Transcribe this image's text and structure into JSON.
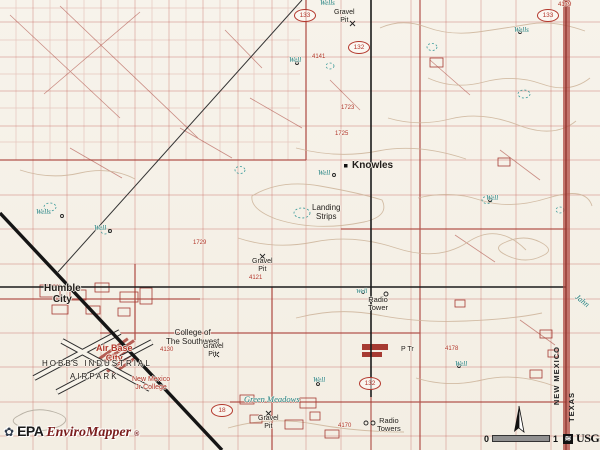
{
  "map": {
    "description": "EPA EnviroMapper USGS topographic map view near Knowles, New Mexico"
  },
  "attribution": {
    "agency": "EPA",
    "product": "EnviroMapper",
    "registered": "®"
  },
  "scale": {
    "zero": "0",
    "one": "1",
    "usgs": "USGS"
  },
  "state_line": {
    "west": "NEW MEXICO",
    "east": "TEXAS"
  },
  "route_shields": [
    {
      "number": "133",
      "x": 294,
      "y": 9
    },
    {
      "number": "132",
      "x": 348,
      "y": 41
    },
    {
      "number": "133",
      "x": 537,
      "y": 9
    },
    {
      "number": "132",
      "x": 359,
      "y": 377
    },
    {
      "number": "18",
      "x": 211,
      "y": 404
    }
  ],
  "map_labels": [
    {
      "name": "label-wells",
      "text": "Wells",
      "x": 320,
      "y": 0,
      "c": "teal",
      "s": 7,
      "i": 1
    },
    {
      "name": "label-gravel-pit",
      "text": "Gravel\nPit",
      "x": 334,
      "y": 9,
      "c": "black",
      "s": 7
    },
    {
      "name": "label-well",
      "text": "Well",
      "x": 289,
      "y": 57,
      "c": "teal",
      "s": 7,
      "i": 1
    },
    {
      "name": "label-wells",
      "text": "Wells",
      "x": 514,
      "y": 27,
      "c": "teal",
      "s": 7,
      "i": 1
    },
    {
      "name": "label-spot-elevation",
      "text": "4179",
      "x": 558,
      "y": 2,
      "c": "red",
      "s": 6
    },
    {
      "name": "label-spot-elevation",
      "text": "4141",
      "x": 312,
      "y": 54,
      "c": "red",
      "s": 6
    },
    {
      "name": "label-spot-elevation",
      "text": "1723",
      "x": 341,
      "y": 105,
      "c": "red",
      "s": 6
    },
    {
      "name": "label-spot-elevation",
      "text": "1725",
      "x": 335,
      "y": 131,
      "c": "red",
      "s": 6
    },
    {
      "name": "label-knowles",
      "text": "Knowles",
      "x": 352,
      "y": 161,
      "c": "black",
      "s": 10,
      "b": 1
    },
    {
      "name": "label-well",
      "text": "Well",
      "x": 318,
      "y": 170,
      "c": "teal",
      "s": 7,
      "i": 1
    },
    {
      "name": "label-well",
      "text": "Well",
      "x": 486,
      "y": 195,
      "c": "teal",
      "s": 7,
      "i": 1
    },
    {
      "name": "label-landing-strips",
      "text": "Landing\nStrips",
      "x": 312,
      "y": 204,
      "c": "black",
      "s": 8
    },
    {
      "name": "label-wells",
      "text": "Wells",
      "x": 36,
      "y": 209,
      "c": "teal",
      "s": 7,
      "i": 1
    },
    {
      "name": "label-well",
      "text": "Well",
      "x": 94,
      "y": 225,
      "c": "teal",
      "s": 7,
      "i": 1
    },
    {
      "name": "label-spot-elevation",
      "text": "1729",
      "x": 193,
      "y": 240,
      "c": "red",
      "s": 6
    },
    {
      "name": "label-gravel-pit",
      "text": "Gravel\nPit",
      "x": 252,
      "y": 258,
      "c": "black",
      "s": 7
    },
    {
      "name": "label-spot-elevation",
      "text": "4121",
      "x": 249,
      "y": 275,
      "c": "red",
      "s": 6
    },
    {
      "name": "label-humble-city",
      "text": "Humble\nCity",
      "x": 44,
      "y": 284,
      "c": "black",
      "s": 10,
      "b": 1
    },
    {
      "name": "label-well",
      "text": "Well",
      "x": 356,
      "y": 288,
      "c": "teal",
      "s": 6.5,
      "i": 1
    },
    {
      "name": "label-radio-tower",
      "text": "Radio\nTower",
      "x": 368,
      "y": 296,
      "c": "black",
      "s": 7.5
    },
    {
      "name": "label-jahn-draw",
      "text": "Jahn",
      "x": 574,
      "y": 297,
      "c": "teal",
      "s": 8,
      "i": 1,
      "r": 38
    },
    {
      "name": "label-college-of-the-southwest",
      "text": "College of\nThe Southwest",
      "x": 166,
      "y": 329,
      "c": "black",
      "s": 8
    },
    {
      "name": "label-gravel-pit",
      "text": "Gravel\nPit.",
      "x": 203,
      "y": 343,
      "c": "black",
      "s": 7
    },
    {
      "name": "label-air-base-city",
      "text": "Air Base\nCity",
      "x": 96,
      "y": 344,
      "c": "red",
      "s": 9,
      "b": 1
    },
    {
      "name": "label-trailer-park",
      "text": "P Tr",
      "x": 401,
      "y": 346,
      "c": "black",
      "s": 7
    },
    {
      "name": "label-spot-elevation",
      "text": "4178",
      "x": 445,
      "y": 346,
      "c": "red",
      "s": 6
    },
    {
      "name": "label-spot-elevation",
      "text": "4130",
      "x": 160,
      "y": 347,
      "c": "red",
      "s": 6
    },
    {
      "name": "label-hobbs-industrial",
      "text": "HOBBS INDUSTRIAL",
      "x": 42,
      "y": 360,
      "c": "black",
      "s": 8,
      "ls": 2
    },
    {
      "name": "label-well",
      "text": "Well",
      "x": 455,
      "y": 361,
      "c": "teal",
      "s": 7,
      "i": 1
    },
    {
      "name": "label-airpark",
      "text": "AIRPARK",
      "x": 70,
      "y": 373,
      "c": "black",
      "s": 8,
      "ls": 2
    },
    {
      "name": "label-nm-jr-college",
      "text": "New Mexico\nJr College",
      "x": 132,
      "y": 376,
      "c": "red",
      "s": 7
    },
    {
      "name": "label-well",
      "text": "Well",
      "x": 313,
      "y": 377,
      "c": "teal",
      "s": 7,
      "i": 1
    },
    {
      "name": "label-green-meadows",
      "text": "Green Meadows",
      "x": 244,
      "y": 395,
      "c": "teal",
      "s": 8.5,
      "i": 1
    },
    {
      "name": "label-gravel-pit",
      "text": "Gravel\nPit",
      "x": 258,
      "y": 415,
      "c": "black",
      "s": 7
    },
    {
      "name": "label-radio-towers",
      "text": "Radio\nTowers",
      "x": 377,
      "y": 417,
      "c": "black",
      "s": 7.5
    },
    {
      "name": "label-spot-elevation",
      "text": "4170",
      "x": 338,
      "y": 423,
      "c": "red",
      "s": 6
    }
  ]
}
